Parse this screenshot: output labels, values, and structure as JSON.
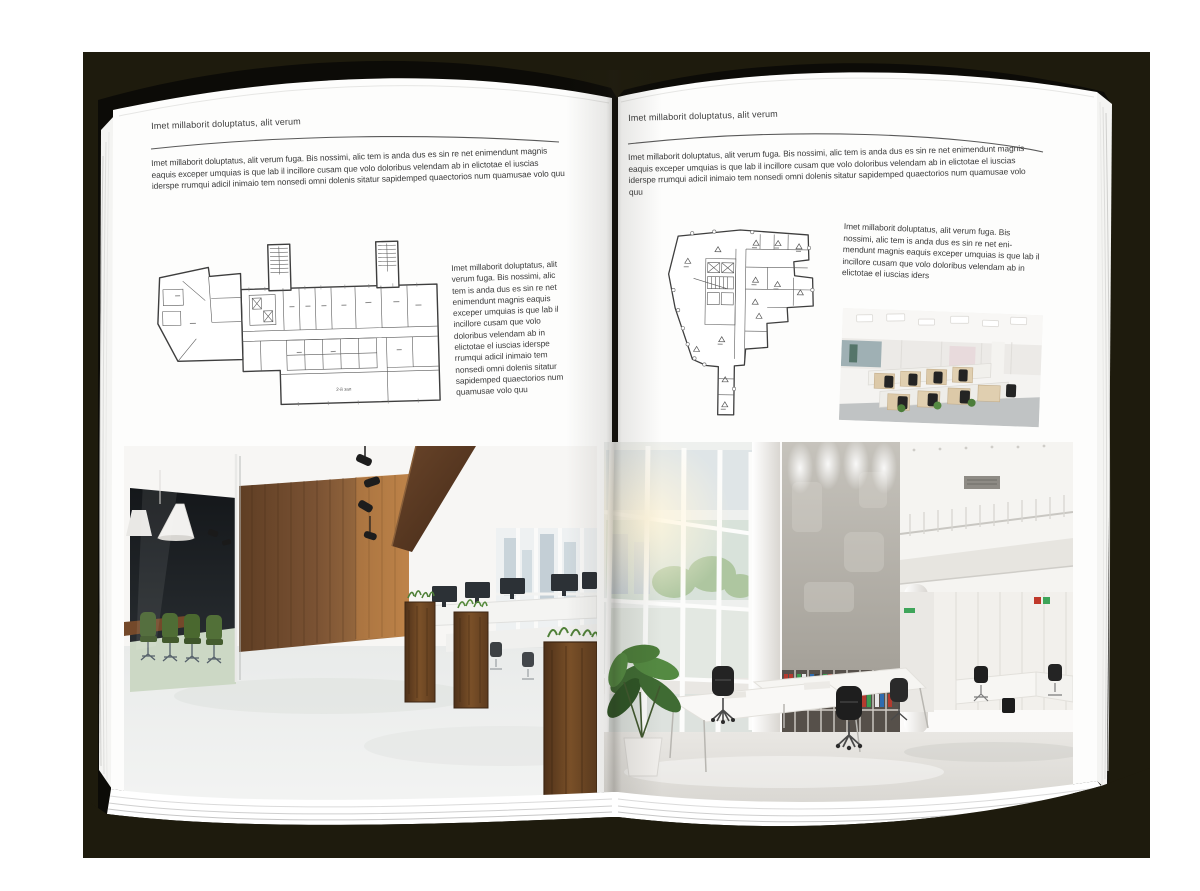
{
  "meta": {
    "backdrop_color": "#1e1b0d",
    "cover_color": "#0c0b07",
    "page_color": "#fdfdfc",
    "rule_color": "#595959",
    "text_color": "#3a3a3a",
    "wood_color": "#7a5233",
    "chair_green": "#4f6d35",
    "plant_green": "#4e7d3c"
  },
  "left_page": {
    "header": "Imet millaborit doluptatus, alit verum",
    "intro": "Imet millaborit doluptatus, alit verum fuga. Bis nossimi, alic tem is anda dus es sin re net enimendunt magnis eaquis exceper umquias is que lab il incillore cusam que volo doloribus velendam ab in elictotae el iuscias iderspe rrumqui adicil inimaio tem nonsedi omni dolenis sitatur sapidemped quaectorios num quamusae volo quu",
    "floorplan": {
      "name": "floor-plan-irregular-wing-building",
      "hall_label": "2-й зал"
    },
    "side_text": "Imet millaborit doluptatus, alit verum fuga. Bis nossimi, alic tem is anda dus es sin re net enimendunt magnis eaquis exceper umquias is que lab il incillore cusam que volo doloribus velendam ab in elictotae el iuscias iderspe rrumqui adicil inimaio tem nonsedi omni dolenis sitatur sapidemped quaectorios num quamusae volo quu",
    "photo_caption": "dark-wood-glass-office-interior"
  },
  "right_page": {
    "header": "Imet millaborit doluptatus, alit verum",
    "intro": "Imet millaborit doluptatus, alit verum fuga. Bis nossimi, alic tem is anda dus es sin re net enimendunt magnis eaquis exceper umquias is que lab il incillore cusam que volo doloribus velendam ab in elictotae el iuscias iderspe rrumqui adicil inimaio tem nonsedi omni dolenis sitatur sapidemped quaectorios num quamusae volo quu",
    "text_block": "Imet millaborit doluptatus, alit verum fuga. Bis nossimi, alic tem is anda dus es sin re net eni-mendunt magnis eaquis exceper umquias is que lab il incillore cusam que volo doloribus velendam ab in elictotae el iuscias iders",
    "floorplan": {
      "name": "floor-plan-wedge-building"
    },
    "small_photo_caption": "white-cubicle-office-interior",
    "photo_caption": "white-atrium-office-interior"
  }
}
